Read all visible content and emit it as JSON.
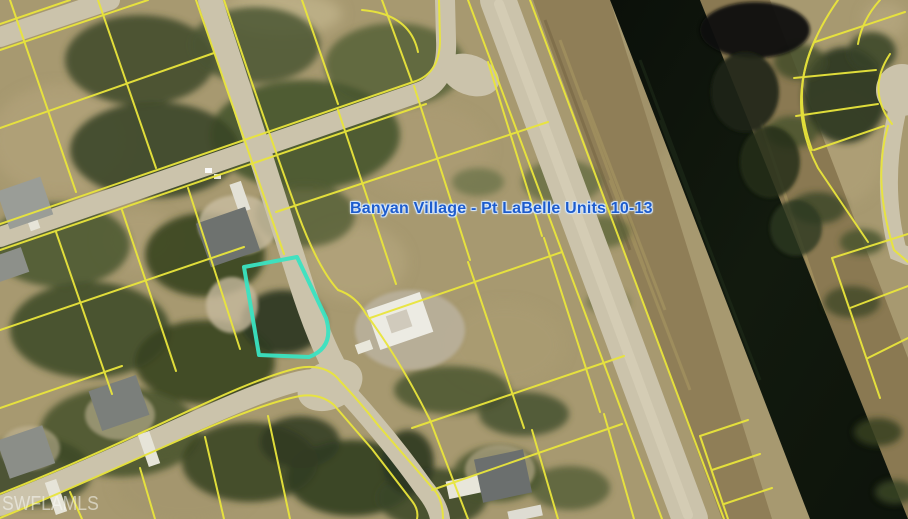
{
  "map": {
    "annotation": {
      "text": "Banyan Village - Pt LaBelle Units 10-13"
    },
    "watermark": {
      "text": "SWFLAMLS"
    },
    "highlighted_parcel": {
      "outline_color": "#3ae3c1"
    },
    "legend_colors": {
      "parcel_line": "#e9e53c",
      "annotation_text": "#1d5ccd",
      "annotation_halo": "#dceaff",
      "watermark_text": "rgba(250,250,245,0.55)",
      "canal_water": "#0e130c",
      "road_surface": "#cbc3ab",
      "graded_dirt": "#8f7e57",
      "ground": "#a79970",
      "vegetation": "#45502f",
      "house_roof": "#6e726f"
    }
  }
}
